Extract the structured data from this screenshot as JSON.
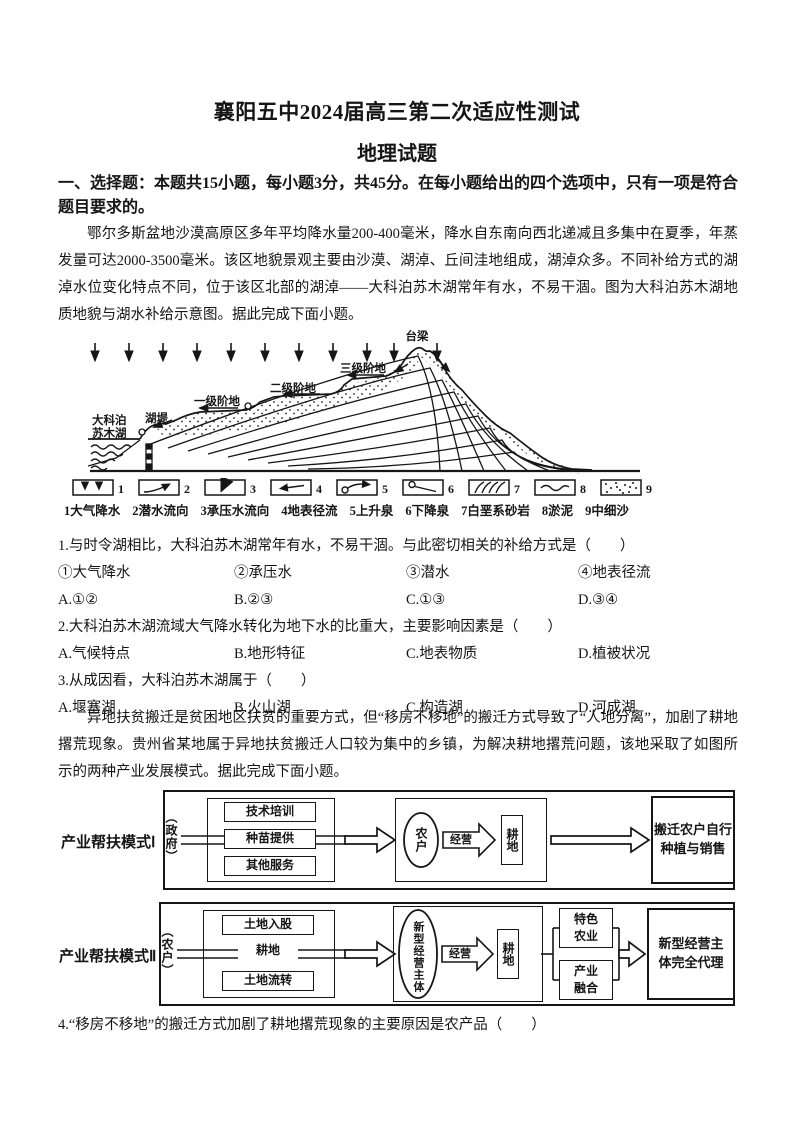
{
  "header": {
    "title": "襄阳五中2024届高三第二次适应性测试",
    "subtitle": "地理试题",
    "section": "一、选择题：本题共15小题，每小题3分，共45分。在每小题给出的四个选项中，只有一项是符合题目要求的。"
  },
  "passages": {
    "p1": "鄂尔多斯盆地沙漠高原区多年平均降水量200-400毫米，降水自东南向西北递减且多集中在夏季，年蒸发量可达2000-3500毫米。该区地貌景观主要由沙漠、湖淖、丘间洼地组成，湖淖众多。不同补给方式的湖淖水位变化特点不同，位于该区北部的湖淖——大科泊苏木湖常年有水，不易干涸。图为大科泊苏木湖地质地貌与湖水补给示意图。据此完成下面小题。",
    "p2": "异地扶贫搬迁是贫困地区扶贫的重要方式，但“移房不移地”的搬迁方式导致了“人地分离”，加剧了耕地撂荒现象。贵州省某地属于异地扶贫搬迁人口较为集中的乡镇，为解决耕地撂荒问题，该地采取了如图所示的两种产业发展模式。据此完成下面小题。"
  },
  "figure1": {
    "labels": {
      "peak": "台梁",
      "terrace3": "三级阶地",
      "terrace2": "二级阶地",
      "terrace1": "一级阶地",
      "dike": "湖堤",
      "lake1": "大科泊",
      "lake2": "苏木湖"
    },
    "legend": [
      {
        "num": "1",
        "name": "大气降水"
      },
      {
        "num": "2",
        "name": "潜水流向"
      },
      {
        "num": "3",
        "name": "承压水流向"
      },
      {
        "num": "4",
        "name": "地表径流"
      },
      {
        "num": "5",
        "name": "上升泉"
      },
      {
        "num": "6",
        "name": "下降泉"
      },
      {
        "num": "7",
        "name": "白垩系砂岩"
      },
      {
        "num": "8",
        "name": "淤泥"
      },
      {
        "num": "9",
        "name": "中细沙"
      }
    ]
  },
  "questions": {
    "q1": {
      "stem": "1.与时令湖相比，大科泊苏木湖常年有水，不易干涸。与此密切相关的补给方式是（　　）",
      "subs": [
        "①大气降水",
        "②承压水",
        "③潜水",
        "④地表径流"
      ],
      "options": [
        "A.①②",
        "B.②③",
        "C.①③",
        "D.③④"
      ]
    },
    "q2": {
      "stem": "2.大科泊苏木湖流域大气降水转化为地下水的比重大，主要影响因素是（　　）",
      "options": [
        "A.气候特点",
        "B.地形特征",
        "C.地表物质",
        "D.植被状况"
      ]
    },
    "q3": {
      "stem": "3.从成因看，大科泊苏木湖属于（　　）",
      "options": [
        "A.堰塞湖",
        "B.火山湖",
        "C.构造湖",
        "D.河成湖"
      ]
    },
    "q4": {
      "stem": "4.“移房不移地”的搬迁方式加剧了耕地撂荒现象的主要原因是农产品（　　）"
    }
  },
  "figure2": {
    "mode1": {
      "label": "产业帮扶模式Ⅰ",
      "actor": "（政府）",
      "services": [
        "技术培训",
        "种苗提供",
        "其他服务"
      ],
      "operator": "农户",
      "verb": "经营",
      "land": "耕地",
      "result": "搬迁农户自行种植与销售"
    },
    "mode2": {
      "label": "产业帮扶模式Ⅱ",
      "actor": "（农户）",
      "inputs": [
        "土地入股",
        "耕地",
        "土地流转"
      ],
      "operator": "新型经营主体",
      "verb": "经营",
      "land": "耕地",
      "branch1": "特色农业",
      "branch2": "产业融合",
      "result": "新型经营主体完全代理"
    }
  }
}
